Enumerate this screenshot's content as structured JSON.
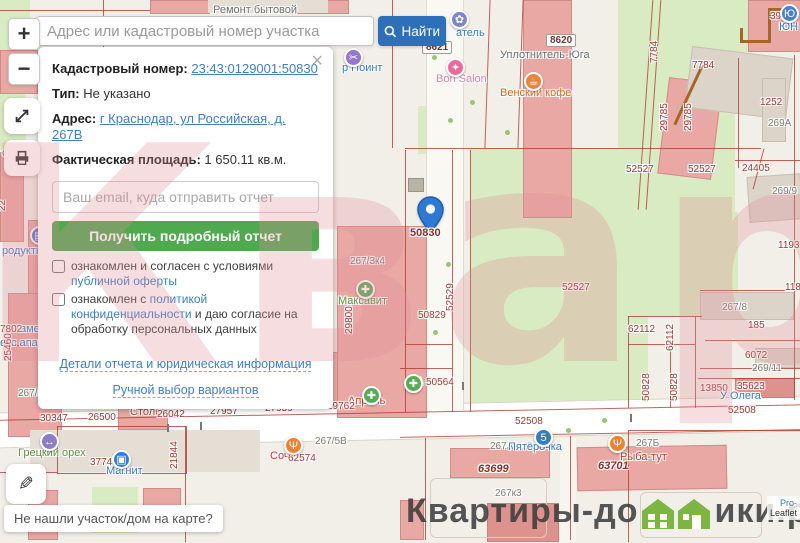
{
  "search": {
    "placeholder": "Адрес или кадастровый номер участка",
    "button_label": "Найти"
  },
  "controls": {
    "zoom_in": "+",
    "zoom_out": "−"
  },
  "panel": {
    "close": "×",
    "cadastral_label": "Кадастровый номер:",
    "cadastral_number": "23:43:0129001:50830",
    "type_label": "Тип:",
    "type_value": "Не указано",
    "address_label": "Адрес:",
    "address_value": "г Краснодар, ул Российская, д. 267В",
    "area_label": "Фактическая площадь:",
    "area_value": "1 650.11 кв.м.",
    "email_placeholder": "Ваш email, куда отправить отчет",
    "submit": "Получить подробный отчет",
    "checkbox1_prefix": "ознакомлен и согласен с условиями ",
    "checkbox1_link": "публичной оферты",
    "checkbox2_prefix": "ознакомлен с ",
    "checkbox2_link": "политикой конфиденциальности",
    "checkbox2_suffix": " и даю согласие на обработку персональных данных",
    "details_link": "Детали отчета и юридическая информация",
    "manual_link": "Ручной выбор вариантов"
  },
  "marker": {
    "label": "50830"
  },
  "tooltip": {
    "text": "Не нашли участок/дом на карте?"
  },
  "logo": {
    "part1": "Квартиры-до",
    "part2": "ики.рф"
  },
  "attribution": {
    "line1": "Pro-",
    "line2": "Leaflet"
  },
  "watermark": {
    "text": "Квартиры"
  },
  "map": {
    "labels": [
      {
        "t": "Ремонт бытовой",
        "x": 213,
        "y": 5,
        "c": "pgray"
      },
      {
        "t": "8621",
        "x": 422,
        "y": 41,
        "c": "shield"
      },
      {
        "t": "8620",
        "x": 546,
        "y": 34,
        "c": "shield"
      },
      {
        "t": "Уплотнитель-Юга",
        "x": 500,
        "y": 50,
        "c": "pgray"
      },
      {
        "t": "р Поинт",
        "x": 342,
        "y": 63,
        "c": "pblue"
      },
      {
        "t": "атель",
        "x": 456,
        "y": 28,
        "c": "pblue"
      },
      {
        "t": "ЮН",
        "x": 779,
        "y": 22,
        "c": "pblue"
      },
      {
        "t": "Bon Salon",
        "x": 436,
        "y": 74,
        "c": "ppink"
      },
      {
        "t": "Венский кофе",
        "x": 500,
        "y": 88,
        "c": "porange"
      },
      {
        "t": "све",
        "x": 2,
        "y": 148,
        "c": "pgreen"
      },
      {
        "t": "родукты",
        "x": 2,
        "y": 246,
        "c": "pblue"
      },
      {
        "t": "аменты",
        "x": 20,
        "y": 324,
        "c": "pblue"
      },
      {
        "t": "екс апартментс",
        "x": 0,
        "y": 338,
        "c": "pblue"
      },
      {
        "t": "390",
        "x": 770,
        "y": 11,
        "c": "num"
      },
      {
        "t": "7784",
        "x": 660,
        "y": 64,
        "c": "num",
        "r": 1
      },
      {
        "t": "7784",
        "x": 692,
        "y": 60,
        "c": "num"
      },
      {
        "t": "29785",
        "x": 670,
        "y": 132,
        "c": "num",
        "r": 1
      },
      {
        "t": "29785",
        "x": 694,
        "y": 132,
        "c": "num",
        "r": 1
      },
      {
        "t": "1252",
        "x": 760,
        "y": 97,
        "c": "num"
      },
      {
        "t": "269А",
        "x": 768,
        "y": 118,
        "c": "addr"
      },
      {
        "t": "269/9",
        "x": 772,
        "y": 186,
        "c": "addr"
      },
      {
        "t": "24405",
        "x": 742,
        "y": 163,
        "c": "num"
      },
      {
        "t": "52527",
        "x": 626,
        "y": 164,
        "c": "num"
      },
      {
        "t": "52527",
        "x": 688,
        "y": 164,
        "c": "num"
      },
      {
        "t": "52527",
        "x": 562,
        "y": 282,
        "c": "num"
      },
      {
        "t": "52529",
        "x": 456,
        "y": 312,
        "c": "num",
        "r": 1
      },
      {
        "t": "50829",
        "x": 418,
        "y": 310,
        "c": "num"
      },
      {
        "t": "А",
        "x": 416,
        "y": 377,
        "c": "pgreen"
      },
      {
        "t": "50564",
        "x": 426,
        "y": 377,
        "c": "num"
      },
      {
        "t": "1193",
        "x": 778,
        "y": 240,
        "c": "num"
      },
      {
        "t": "118",
        "x": 785,
        "y": 282,
        "c": "num"
      },
      {
        "t": "267/8",
        "x": 722,
        "y": 302,
        "c": "addr"
      },
      {
        "t": "185",
        "x": 748,
        "y": 320,
        "c": "num"
      },
      {
        "t": "6072",
        "x": 745,
        "y": 350,
        "c": "num"
      },
      {
        "t": "269/11",
        "x": 752,
        "y": 363,
        "c": "addr"
      },
      {
        "t": "62112",
        "x": 628,
        "y": 324,
        "c": "num"
      },
      {
        "t": "62112",
        "x": 676,
        "y": 352,
        "c": "num",
        "r": 1
      },
      {
        "t": "50828",
        "x": 652,
        "y": 402,
        "c": "num",
        "r": 1
      },
      {
        "t": "50828",
        "x": 680,
        "y": 402,
        "c": "num",
        "r": 1
      },
      {
        "t": "13850",
        "x": 700,
        "y": 383,
        "c": "num"
      },
      {
        "t": "35623",
        "x": 737,
        "y": 381,
        "c": "num"
      },
      {
        "t": "У Олега",
        "x": 720,
        "y": 391,
        "c": "pblue"
      },
      {
        "t": "52508",
        "x": 515,
        "y": 416,
        "c": "num"
      },
      {
        "t": "52508",
        "x": 728,
        "y": 405,
        "c": "num"
      },
      {
        "t": "267/3к4",
        "x": 350,
        "y": 256,
        "c": "addr"
      },
      {
        "t": "Максавит",
        "x": 338,
        "y": 296,
        "c": "pgreen"
      },
      {
        "t": "29800",
        "x": 355,
        "y": 335,
        "c": "num",
        "r": 1
      },
      {
        "t": "Апрель",
        "x": 348,
        "y": 396,
        "c": "pred"
      },
      {
        "t": "7802",
        "x": 0,
        "y": 324,
        "c": "num"
      },
      {
        "t": "25460",
        "x": 14,
        "y": 362,
        "c": "num",
        "r": 1
      },
      {
        "t": "231",
        "x": 128,
        "y": 352,
        "c": "num",
        "r": 1
      },
      {
        "t": "22",
        "x": 8,
        "y": 212,
        "c": "num",
        "r": 1
      },
      {
        "t": "267/3к1",
        "x": 18,
        "y": 388,
        "c": "addr"
      },
      {
        "t": "30347",
        "x": 40,
        "y": 413,
        "c": "num"
      },
      {
        "t": "26500",
        "x": 88,
        "y": 412,
        "c": "num"
      },
      {
        "t": "Столов",
        "x": 130,
        "y": 407,
        "c": "pred"
      },
      {
        "t": "26042",
        "x": 157,
        "y": 409,
        "c": "num"
      },
      {
        "t": "АптекаПлюс",
        "x": 165,
        "y": 386,
        "c": "pgreen"
      },
      {
        "t": "27957",
        "x": 210,
        "y": 406,
        "c": "num"
      },
      {
        "t": "Вита-Экспресс",
        "x": 248,
        "y": 393,
        "c": "pgreen"
      },
      {
        "t": "27959",
        "x": 265,
        "y": 403,
        "c": "num"
      },
      {
        "t": "29762",
        "x": 327,
        "y": 401,
        "c": "num"
      },
      {
        "t": "267/5В",
        "x": 315,
        "y": 436,
        "c": "addr"
      },
      {
        "t": "Соч",
        "x": 270,
        "y": 451,
        "c": "pred"
      },
      {
        "t": "62574",
        "x": 288,
        "y": 453,
        "c": "num"
      },
      {
        "t": "Грецкий орех",
        "x": 18,
        "y": 448,
        "c": "pgreen"
      },
      {
        "t": "37748",
        "x": 90,
        "y": 457,
        "c": "num"
      },
      {
        "t": "Магнит",
        "x": 106,
        "y": 466,
        "c": "pblue"
      },
      {
        "t": "21844",
        "x": 180,
        "y": 470,
        "c": "num",
        "r": 1
      },
      {
        "t": "267А",
        "x": 490,
        "y": 441,
        "c": "addr"
      },
      {
        "t": "Пятёрочка",
        "x": 508,
        "y": 442,
        "c": "pblue"
      },
      {
        "t": "63699",
        "x": 478,
        "y": 464,
        "c": "iti"
      },
      {
        "t": "267Б",
        "x": 636,
        "y": 438,
        "c": "addr"
      },
      {
        "t": "Рыба-тут",
        "x": 620,
        "y": 452,
        "c": "pred"
      },
      {
        "t": "63701",
        "x": 598,
        "y": 461,
        "c": "iti"
      },
      {
        "t": "267к3",
        "x": 495,
        "y": 488,
        "c": "addr"
      },
      {
        "t": "Парус",
        "x": 85,
        "y": 516,
        "c": "pgreen"
      }
    ],
    "pois": [
      {
        "n": "scissors-icon",
        "g": "✂",
        "x": 344,
        "y": 48,
        "bg": "#9575cd"
      },
      {
        "n": "paw-icon",
        "g": "✿",
        "x": 450,
        "y": 10,
        "bg": "#7986cb"
      },
      {
        "n": "nail-polish-icon",
        "g": "✦",
        "x": 446,
        "y": 58,
        "bg": "#ec6a9b"
      },
      {
        "n": "coffee-icon",
        "g": "☕",
        "x": 524,
        "y": 72,
        "bg": "#e8853c"
      },
      {
        "n": "grocery-icon",
        "g": "▤",
        "x": 30,
        "y": 226,
        "bg": "#4a7fd4"
      },
      {
        "n": "pet-store-icon",
        "g": "Ю",
        "x": 780,
        "y": 4,
        "bg": "#4a7fd4"
      },
      {
        "n": "pharmacy-plus-icon",
        "g": "✚",
        "x": 356,
        "y": 280,
        "bg": "#56ab56"
      },
      {
        "n": "pharmacy-plus-icon",
        "g": "✚",
        "x": 362,
        "y": 386,
        "bg": "#56ab56"
      },
      {
        "n": "pharmacy-plus-icon",
        "g": "✚",
        "x": 230,
        "y": 384,
        "bg": "#56ab56"
      },
      {
        "n": "pharmacy-plus-icon",
        "g": "✚",
        "x": 291,
        "y": 377,
        "bg": "#56ab56"
      },
      {
        "n": "pharmacy-plus-icon",
        "g": "✚",
        "x": 404,
        "y": 374,
        "bg": "#56ab56"
      },
      {
        "n": "transfer-arrows-icon",
        "g": "↔",
        "x": 40,
        "y": 432,
        "bg": "#8e7cc3"
      },
      {
        "n": "magnit-bag-icon",
        "g": "▣",
        "x": 112,
        "y": 450,
        "bg": "#2f7de0"
      },
      {
        "n": "pyaterochka-icon",
        "g": "5",
        "x": 534,
        "y": 428,
        "bg": "#3d7ab8"
      },
      {
        "n": "restaurant-icon",
        "g": "Ψ",
        "x": 284,
        "y": 436,
        "bg": "#ef8232"
      },
      {
        "n": "fish-restaurant-icon",
        "g": "Ψ",
        "x": 608,
        "y": 434,
        "bg": "#ef8232"
      }
    ]
  }
}
